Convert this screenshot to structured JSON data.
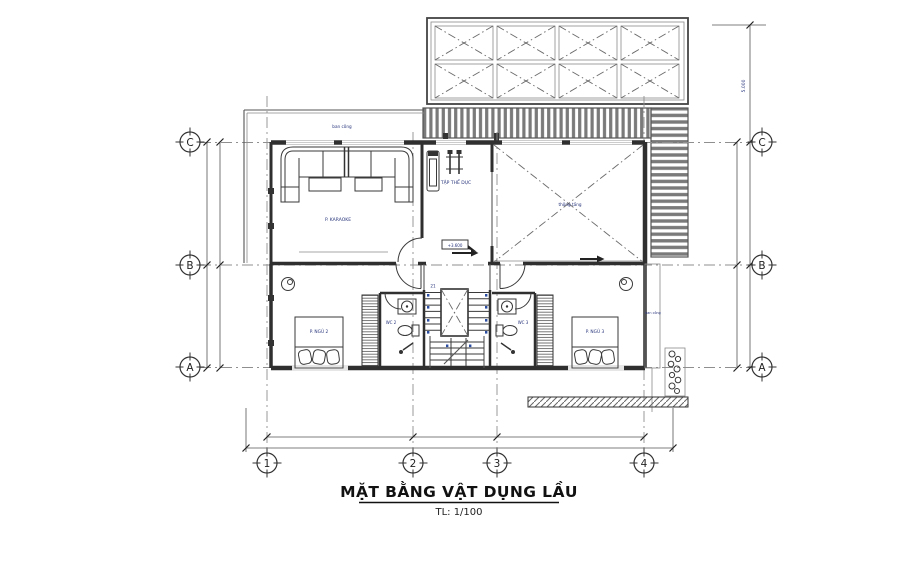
{
  "drawing": {
    "title": "MẶT BẰNG VẬT DỤNG LẦU",
    "scale": "TL: 1/100"
  },
  "grid": {
    "row_labels": [
      "C",
      "B",
      "A"
    ],
    "col_labels": [
      "1",
      "2",
      "3",
      "4"
    ]
  },
  "dims": {
    "roof_height": "5.000"
  },
  "rooms": {
    "karaoke": "P. KARAOKE",
    "gym": "TẬP THỂ DỤC",
    "void": "thông tầng",
    "bedroom_left": "P. NGỦ 2",
    "bedroom_right": "P. NGỦ 3",
    "wc_left": "WC 2",
    "wc_right": "WC 3",
    "balcony_top": "ban công",
    "balcony_right": "ban công"
  },
  "ann": {
    "level": "+3.600",
    "steps": "21"
  },
  "colors": {
    "wall": "#2f2f2f",
    "label_blue": "#26337a",
    "hatch_gray": "#7a7a7a"
  }
}
